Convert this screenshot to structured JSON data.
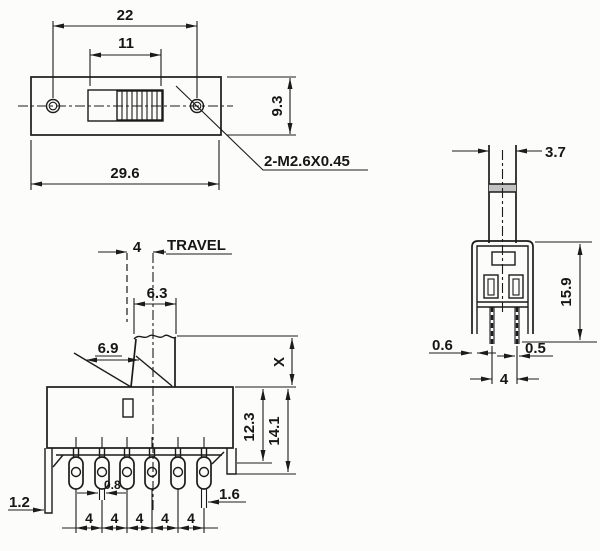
{
  "drawing": {
    "description": "Slide switch engineering drawing, three orthographic views",
    "background": "#fcfcfb",
    "line_color": "#1b1b1b",
    "top_view": {
      "name": "top-view",
      "dims": {
        "hole_span": "22",
        "slot_width": "11",
        "body_length": "29.6",
        "body_width": "9.3"
      },
      "thread_note": "2-M2.6X0.45"
    },
    "front_view": {
      "name": "front-view",
      "dims": {
        "travel": "4",
        "travel_label": "TRAVEL",
        "knob_top": "6.3",
        "knob_slant": "6.9",
        "knob_height": "X",
        "body_depth": "12.3",
        "overall_depth": "14.1",
        "foot_left": "1.2",
        "foot_right": "1.6",
        "terminal_thickness": "0.8"
      },
      "pitch_labels": [
        "4",
        "4",
        "4",
        "4",
        "4"
      ]
    },
    "side_view": {
      "name": "side-view",
      "dims": {
        "knob_width": "3.7",
        "body_height": "15.9",
        "bracket_thickness": "0.6",
        "pin_thickness": "0.5",
        "pin_pitch": "4"
      }
    }
  }
}
